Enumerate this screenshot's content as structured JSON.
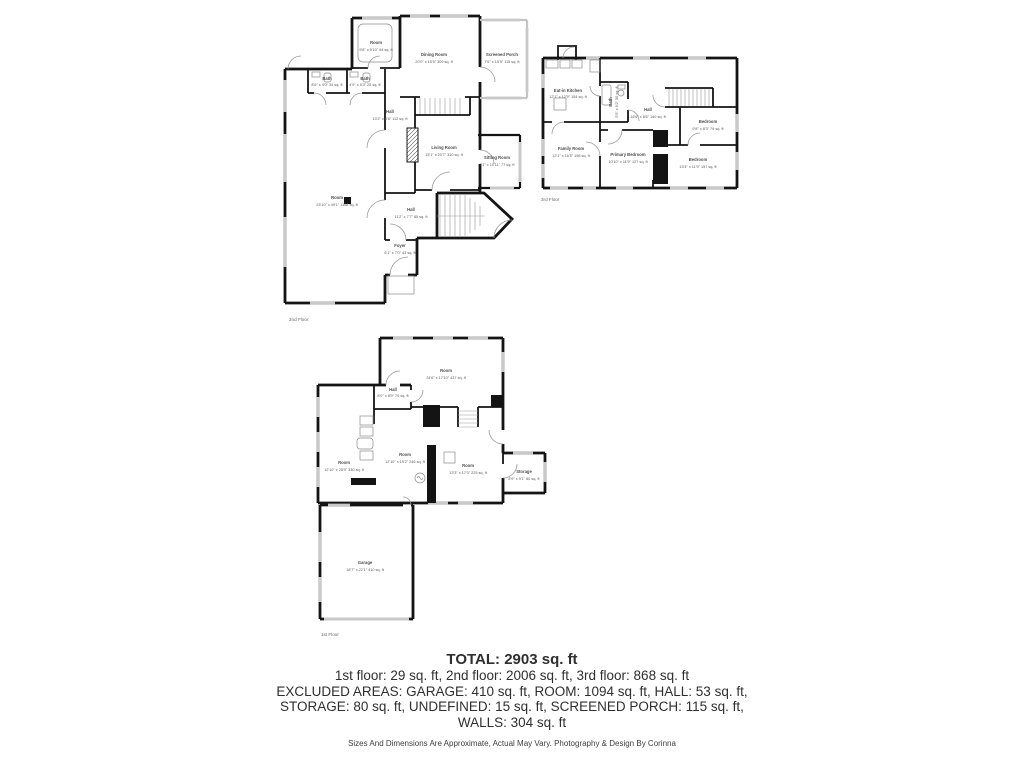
{
  "canvas": {
    "bg": "#ffffff"
  },
  "colors": {
    "wall": "#141414",
    "window": "#c9c9c9",
    "label": "#4d4d4d",
    "text": "#2f2f2f"
  },
  "floors": {
    "second": {
      "caption": "2nd Floor",
      "rooms": {
        "room_small": {
          "name": "Room",
          "dims": "9'8\" x 9'10\" 94 sq. ft"
        },
        "dining": {
          "name": "Dining Room",
          "dims": "20'0\" x 15'5\" 309 sq. ft"
        },
        "screened_porch": {
          "name": "Screened Porch",
          "dims": "7'6\" x 15'5\" 115 sq. ft"
        },
        "bath_left": {
          "name": "Bath",
          "dims": "8'6\" x 4'0\" 34 sq. ft"
        },
        "bath_right": {
          "name": "Bath",
          "dims": "4'9\" x 5'3\" 25 sq. ft"
        },
        "hall_upper": {
          "name": "Hall",
          "dims": "13'2\" x 8'6\" 112 sq. ft"
        },
        "living": {
          "name": "Living Room",
          "dims": "15'1\" x 20'7\" 310 sq. ft"
        },
        "sitting": {
          "name": "Sitting Room",
          "dims": "7'1\" x 10'11\" 77 sq. ft"
        },
        "room_large": {
          "name": "Room",
          "dims": "23'10\" x 49'1\" 1168 sq. ft"
        },
        "hall_lower": {
          "name": "Hall",
          "dims": "11'2\" x 7'7\" 85 sq. ft"
        },
        "foyer": {
          "name": "Foyer",
          "dims": "6'1\" x 7'0\" 43 sq. ft"
        }
      }
    },
    "third": {
      "caption": "3rd Floor",
      "rooms": {
        "kitchen": {
          "name": "Eat-in Kitchen",
          "dims": "12'1\" x 12'9\" 154 sq. ft"
        },
        "bath": {
          "name": "Bath",
          "dims": "5'5\" x 9'2\" 50 sq. ft"
        },
        "hall": {
          "name": "Hall",
          "dims": "16'6\" x 8'6\" 140 sq. ft"
        },
        "bedroom_small": {
          "name": "Bedroom",
          "dims": "9'8\" x 8'3\" 79 sq. ft"
        },
        "family": {
          "name": "Family Room",
          "dims": "12'1\" x 16'5\" 198 sq. ft"
        },
        "primary": {
          "name": "Primary Bedroom",
          "dims": "10'10\" x 11'9\" 127 sq. ft"
        },
        "bedroom_large": {
          "name": "Bedroom",
          "dims": "13'4\" x 11'9\" 157 sq. ft"
        }
      }
    },
    "first": {
      "caption": "1st Floor",
      "rooms": {
        "room_top": {
          "name": "Room",
          "dims": "24'6\" x 17'10\" 437 sq. ft"
        },
        "hall": {
          "name": "Hall",
          "dims": "8'0\" x 8'9\" 70 sq. ft"
        },
        "room_left": {
          "name": "Room",
          "dims": "12'10\" x 25'9\" 330 sq. ft"
        },
        "room_center": {
          "name": "Room",
          "dims": "12'10\" x 19'2\" 246 sq. ft"
        },
        "room_right": {
          "name": "Room",
          "dims": "13'3\" x 17'0\" 225 sq. ft"
        },
        "storage": {
          "name": "Storage",
          "dims": "8'9\" x 9'1\" 80 sq. ft"
        },
        "garage": {
          "name": "Garage",
          "dims": "18'7\" x 22'1\" 410 sq. ft"
        }
      }
    }
  },
  "summary": {
    "total": "TOTAL: 2903 sq. ft",
    "lines": [
      "1st floor: 29 sq. ft, 2nd floor: 2006 sq. ft, 3rd floor: 868 sq. ft",
      "EXCLUDED AREAS: GARAGE: 410 sq. ft, ROOM: 1094 sq. ft, HALL: 53 sq. ft,",
      "STORAGE: 80 sq. ft, UNDEFINED: 15 sq. ft, SCREENED PORCH: 115 sq. ft,",
      "WALLS: 304 sq. ft"
    ]
  },
  "footer": "Sizes And Dimensions Are Approximate, Actual May Vary. Photography & Design By Corinna"
}
